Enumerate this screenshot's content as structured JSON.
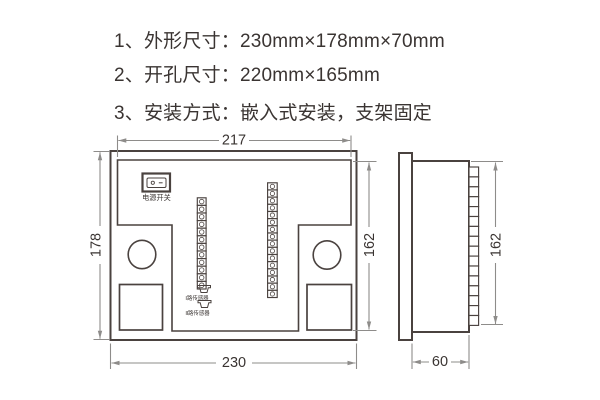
{
  "specs": {
    "items": [
      {
        "text": "1、外形尺寸：230mm×178mm×70mm"
      },
      {
        "text": "2、开孔尺寸：220mm×165mm"
      },
      {
        "text": "3、安装方式：嵌入式安装，支架固定"
      }
    ]
  },
  "rear_view": {
    "power_switch_label": "电源开关",
    "sensor1_label": "Ⅰ路传感器",
    "sensor2_label": "Ⅱ路传感器",
    "terminals": {
      "left_count": 12,
      "right_count": 16
    },
    "dims": {
      "inner_width": "217",
      "outer_height": "178",
      "inner_height": "162",
      "outer_width": "230"
    }
  },
  "side_view": {
    "terminals": {
      "count": 16
    },
    "dims": {
      "height": "162",
      "depth": "60"
    }
  },
  "colors": {
    "outline": "#4a423f",
    "dimension": "#8e8c8a",
    "text": "#3a3432"
  }
}
